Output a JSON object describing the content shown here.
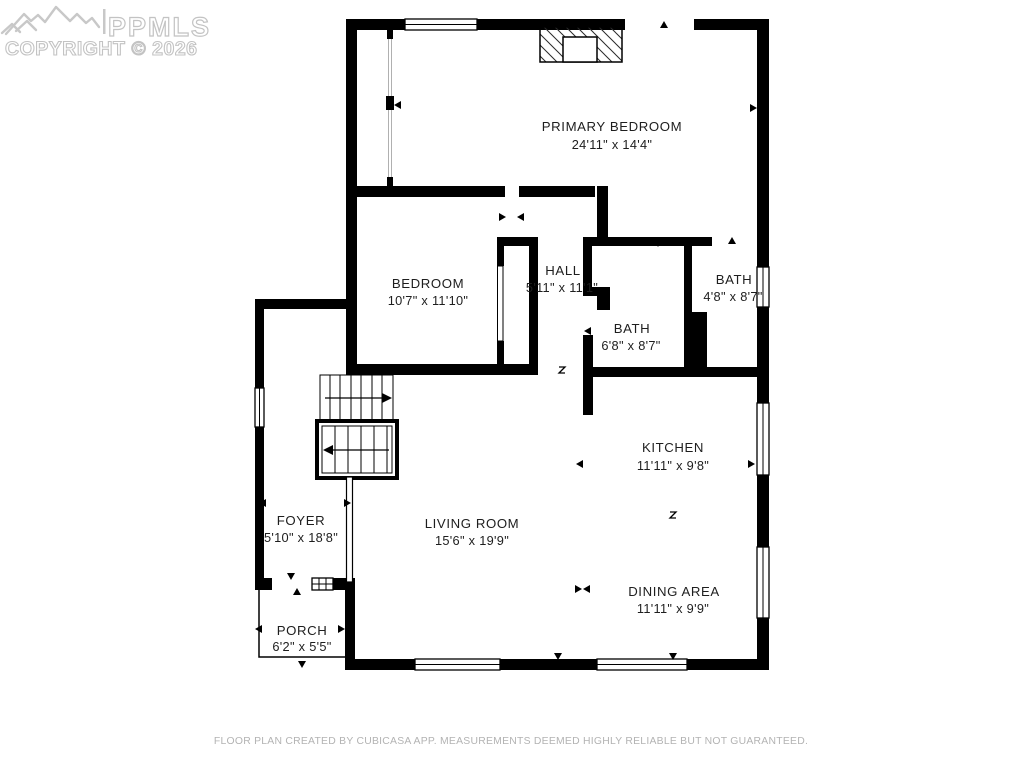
{
  "watermark": {
    "brand": "PPMLS",
    "copyright": "COPYRIGHT © 2026"
  },
  "rooms": [
    {
      "id": "primary-bedroom",
      "name": "PRIMARY BEDROOM",
      "dims": "24'11\" x 14'4\""
    },
    {
      "id": "bedroom",
      "name": "BEDROOM",
      "dims": "10'7\" x 11'10\""
    },
    {
      "id": "hall",
      "name": "HALL",
      "dims": "5'11\" x 11'1\""
    },
    {
      "id": "bath",
      "name": "BATH",
      "dims": "6'8\" x 8'7\""
    },
    {
      "id": "bath-2",
      "name": "BATH",
      "dims": "4'8\" x 8'7\""
    },
    {
      "id": "kitchen",
      "name": "KITCHEN",
      "dims": "11'11\" x 9'8\""
    },
    {
      "id": "living-room",
      "name": "LIVING ROOM",
      "dims": "15'6\" x 19'9\""
    },
    {
      "id": "foyer",
      "name": "FOYER",
      "dims": "5'10\" x 18'8\""
    },
    {
      "id": "dining-area",
      "name": "DINING AREA",
      "dims": "11'11\" x 9'9\""
    },
    {
      "id": "porch",
      "name": "PORCH",
      "dims": "6'2\" x 5'5\""
    }
  ],
  "footer": {
    "disclaimer": "FLOOR PLAN CREATED BY CUBICASA APP. MEASUREMENTS DEEMED HIGHLY RELIABLE BUT NOT GUARANTEED."
  },
  "colors": {
    "background": "#ffffff",
    "walls": "#000000",
    "label_text": "#1e1e1e",
    "watermark": "#c3c3c3",
    "footer_text": "#b3b3b3"
  }
}
